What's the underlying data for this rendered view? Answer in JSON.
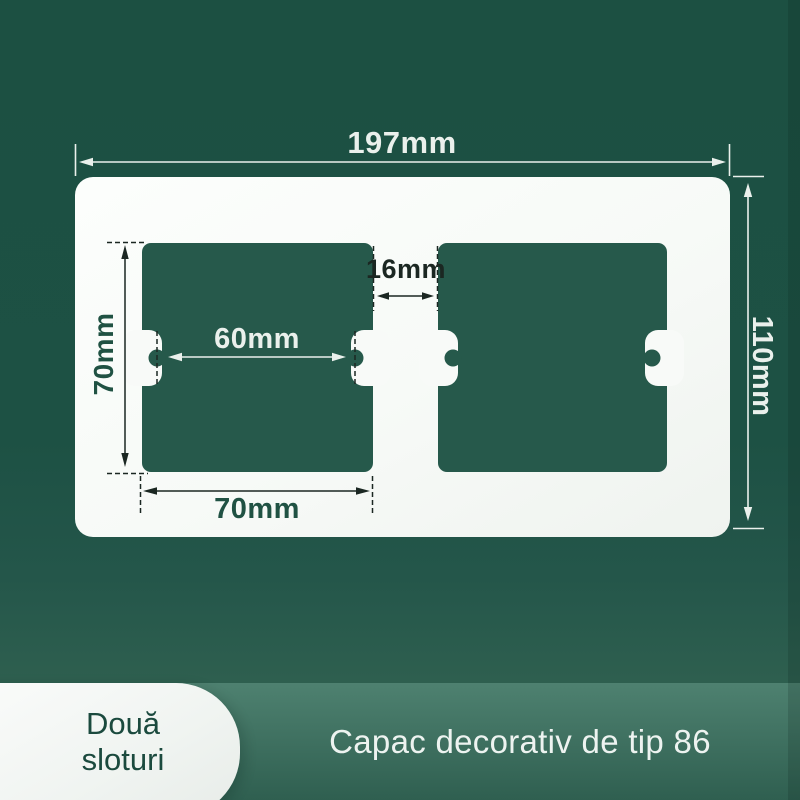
{
  "product": {
    "badge_line1": "Două",
    "badge_line2": "sloturi",
    "caption": "Capac decorativ de tip 86",
    "type": "two-gang type 86 decorative wall plate cover"
  },
  "dimensions": {
    "plate_width": "197mm",
    "plate_height": "110mm",
    "slot_height": "70mm",
    "screw_hole_distance": "60mm",
    "slot_gap": "16mm",
    "slot_width": "70mm"
  },
  "colors": {
    "background": "#1d5143",
    "background_glow": "#2e5f4f",
    "cutout": "#26594b",
    "plate": "#f8faf8",
    "plate_hi": "#fcfefc",
    "plate_lo": "#eff3ef",
    "band_top": "#4e8170",
    "band_bottom": "#2f5f50",
    "badge_bg": "#f0f4f1",
    "badge_text": "#1b4a3e",
    "caption_text": "#edf3f0",
    "dim_light": "#eaf0ec",
    "dim_dark": "#1b2722",
    "dim_green": "#205243",
    "strip": "rgba(4,22,17,0.16)"
  }
}
